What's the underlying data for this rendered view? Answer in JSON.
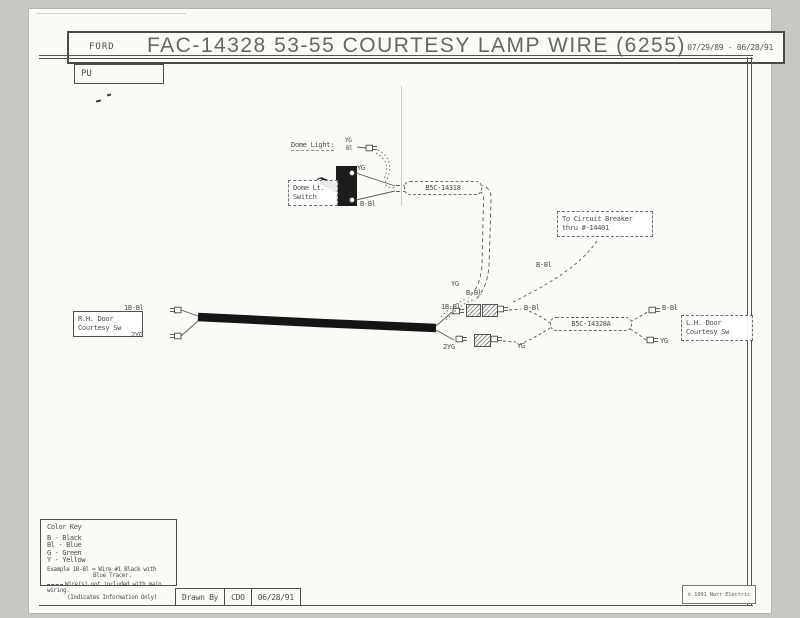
{
  "header": {
    "brand": "FORD",
    "title": "FAC-14328  53-55 COURTESY LAMP WIRE  (6255)",
    "date_range": "07/29/89 - 06/28/91",
    "page_code": "PU"
  },
  "diagram": {
    "dome_light_label": "Dome Light:",
    "dome_light_wire_top": "YG",
    "dome_light_wire_bottom": "Bl",
    "dome_switch_line1": "Dome Lt.",
    "dome_switch_line2": "Switch",
    "switch_wire_top": "YG",
    "switch_wire_bottom": "B-Bl",
    "harness_main": "B5C-14318",
    "circuit_breaker_line1": "To Circuit Breaker",
    "circuit_breaker_line2": "thru #-14401",
    "breaker_wire": "B-Bl",
    "branch_wire_yg": "YG",
    "branch_wire_bbl": "B-Bl",
    "rh_switch_line1": "R.H. Door",
    "rh_switch_line2": "Courtesy Sw",
    "rh_wire_top": "1B-Bl",
    "rh_wire_bottom": "2YG",
    "junction_left_top": "1B-Bl",
    "junction_left_bottom": "2YG",
    "junction_right_top": "B-Bl",
    "junction_right_bottom": "YG",
    "harness_lh": "B5C-14328A",
    "lh_wire_top": "B-Bl",
    "lh_wire_bottom": "YG",
    "lh_switch_line1": "L.H. Door",
    "lh_switch_line2": "Courtesy Sw"
  },
  "color_key": {
    "title": "Color Key",
    "entries": [
      "B - Black",
      "Bl - Blue",
      "G - Green",
      "Y - Yellow"
    ],
    "example_line1": "Example 1B-Bl = Wire #1 Black with",
    "example_line2": "Blue Tracer.",
    "note_line1": "Wire(s) not included with main wiring.",
    "note_line2": "(Indicates Information Only)"
  },
  "footer": {
    "drawn_by_label": "Drawn By",
    "drawn_by_value": "CDO",
    "date": "06/28/91",
    "copyright": "© 1991 Narr Electric"
  },
  "colors": {
    "ink": "#4d4d4d",
    "paper": "#fbfaf7",
    "cable": "#151515"
  }
}
